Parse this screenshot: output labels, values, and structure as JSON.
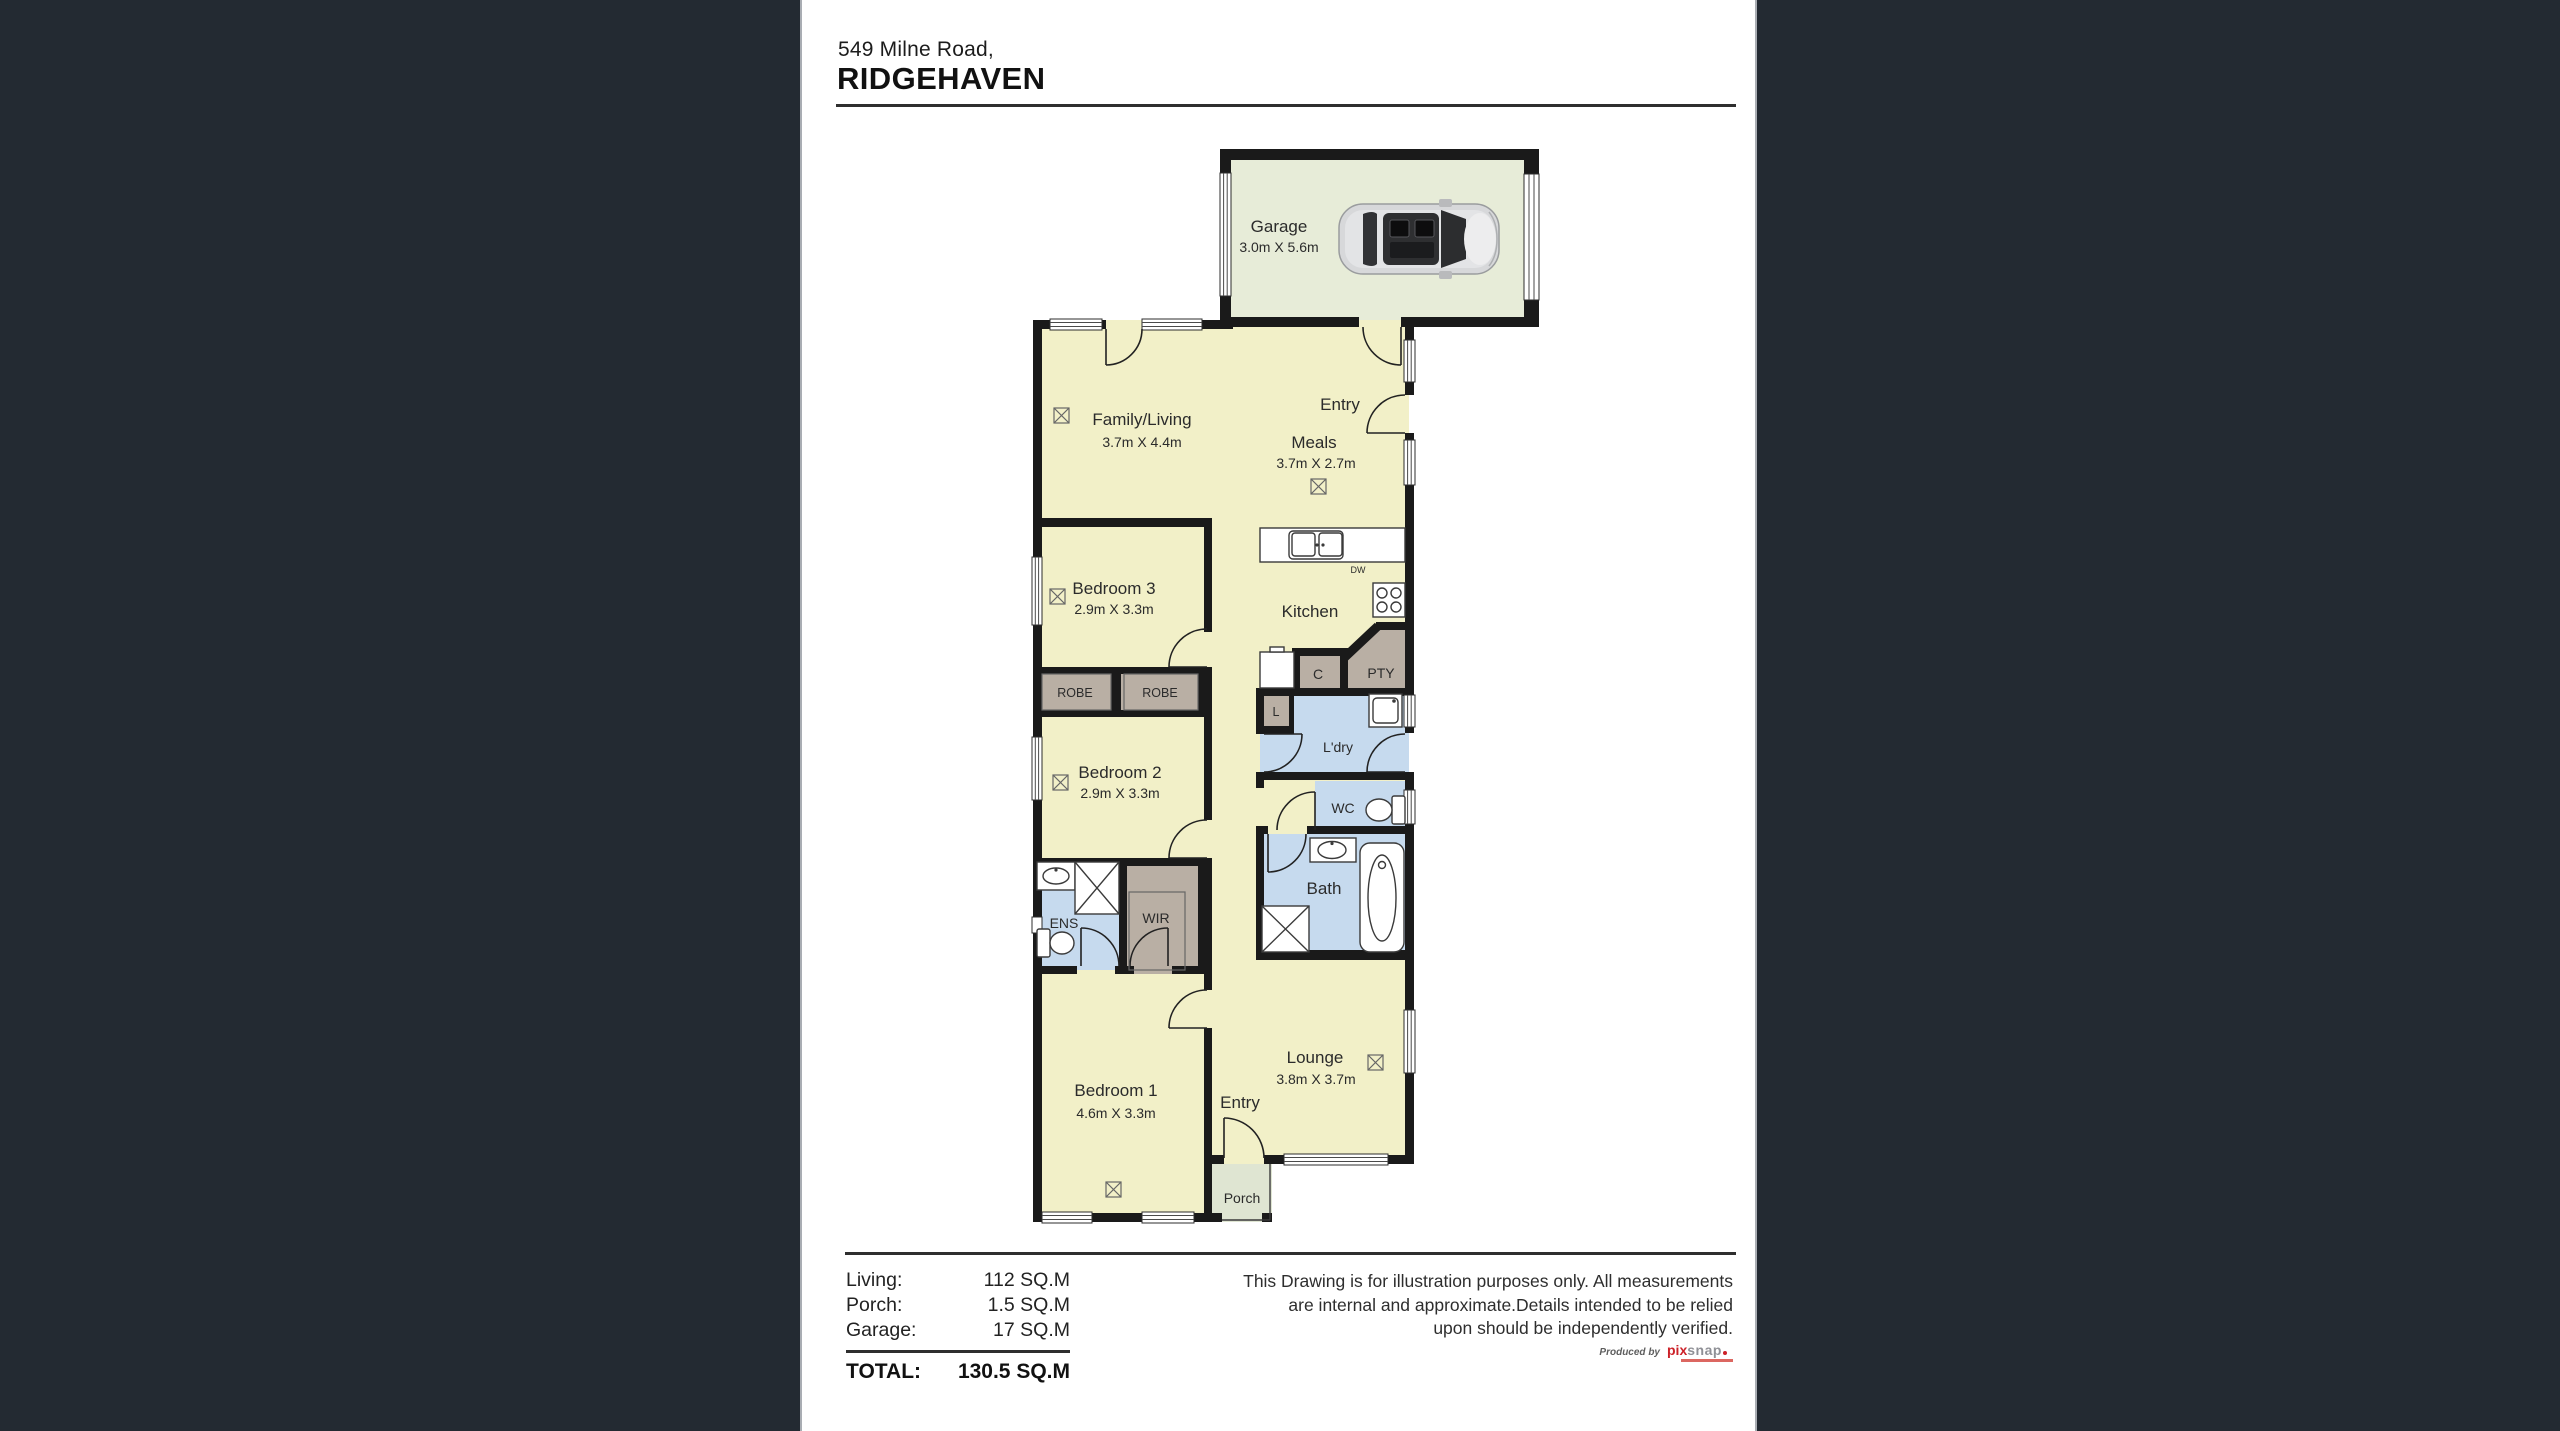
{
  "header": {
    "address_line": "549 Milne Road,",
    "locality": "RIDGEHAVEN"
  },
  "plan": {
    "labels": {
      "garage": "Garage",
      "garage_dims": "3.0m X 5.6m",
      "family": "Family/Living",
      "family_dims": "3.7m X 4.4m",
      "entry_top": "Entry",
      "meals": "Meals",
      "meals_dims": "3.7m X 2.7m",
      "kitchen": "Kitchen",
      "dw": "DW",
      "cupboard": "C",
      "pantry": "PTY",
      "linen": "L",
      "laundry": "L'dry",
      "wc": "WC",
      "bath": "Bath",
      "robe1": "ROBE",
      "robe2": "ROBE",
      "bed3": "Bedroom 3",
      "bed3_dims": "2.9m X 3.3m",
      "bed2": "Bedroom 2",
      "bed2_dims": "2.9m X 3.3m",
      "ens": "ENS",
      "wir": "WIR",
      "bed1": "Bedroom 1",
      "bed1_dims": "4.6m X 3.3m",
      "entry_bottom": "Entry",
      "lounge": "Lounge",
      "lounge_dims": "3.8m X 3.7m",
      "porch": "Porch"
    }
  },
  "areas": {
    "rows": [
      {
        "label": "Living:",
        "value": "112 SQ.M"
      },
      {
        "label": "Porch:",
        "value": "1.5 SQ.M"
      },
      {
        "label": "Garage:",
        "value": "17 SQ.M"
      }
    ],
    "total_label": "TOTAL:",
    "total_value": "130.5 SQ.M"
  },
  "disclaimer": {
    "line1": "This Drawing is for illustration purposes only. All measurements",
    "line2": "are internal and approximate.Details intended to be relied",
    "line3": "upon should be independently verified."
  },
  "credit": {
    "prefix": "Produced by",
    "brand_a": "pix",
    "brand_b": "snap"
  },
  "colors": {
    "page_bg": "#232a32",
    "sheet": "#ffffff",
    "floor": "#f2f0c8",
    "garage_floor": "#e7ecd8",
    "porch_floor": "#dfe5d2",
    "wet": "#c6daee",
    "robe": "#b9afa4",
    "wall": "#1a1a1a",
    "ink": "#2d2d2d",
    "brand_red": "#cc2128"
  }
}
